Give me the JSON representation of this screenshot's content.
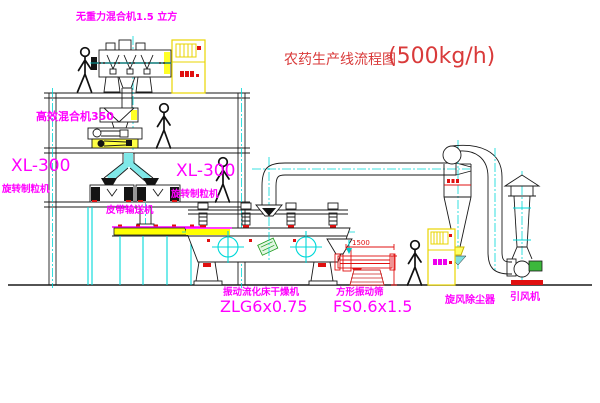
{
  "title": {
    "text_zh": "农药生产线流程图",
    "capacity": "(500kg/h)"
  },
  "labels": {
    "gravity_mixer": "无重力混合机1.5 立方",
    "high_eff_mixer": "高效混合机350",
    "granulator_left_model": "XL-300",
    "granulator_left_name": "旋转制粒机",
    "granulator_right_model": "XL-300",
    "granulator_right_name": "旋转制粒机",
    "belt_conveyor": "皮带输送机",
    "fluid_bed_dryer": "振动流化床干燥机",
    "fluid_bed_dryer_model": "ZLG6x0.75",
    "square_sieve": "方形振动筛",
    "square_sieve_model": "FS0.6x1.5",
    "cyclone": "旋风除尘器",
    "draft_fan": "引风机",
    "sieve_dimension": "1500"
  },
  "colors": {
    "label_magenta": "#ff00ff",
    "title_red": "#d93a3a",
    "centerline_cyan": "#00d8d8",
    "highlight_yellow": "#ffff00",
    "accent_red": "#e01010",
    "motor_green": "#3cb83c"
  }
}
